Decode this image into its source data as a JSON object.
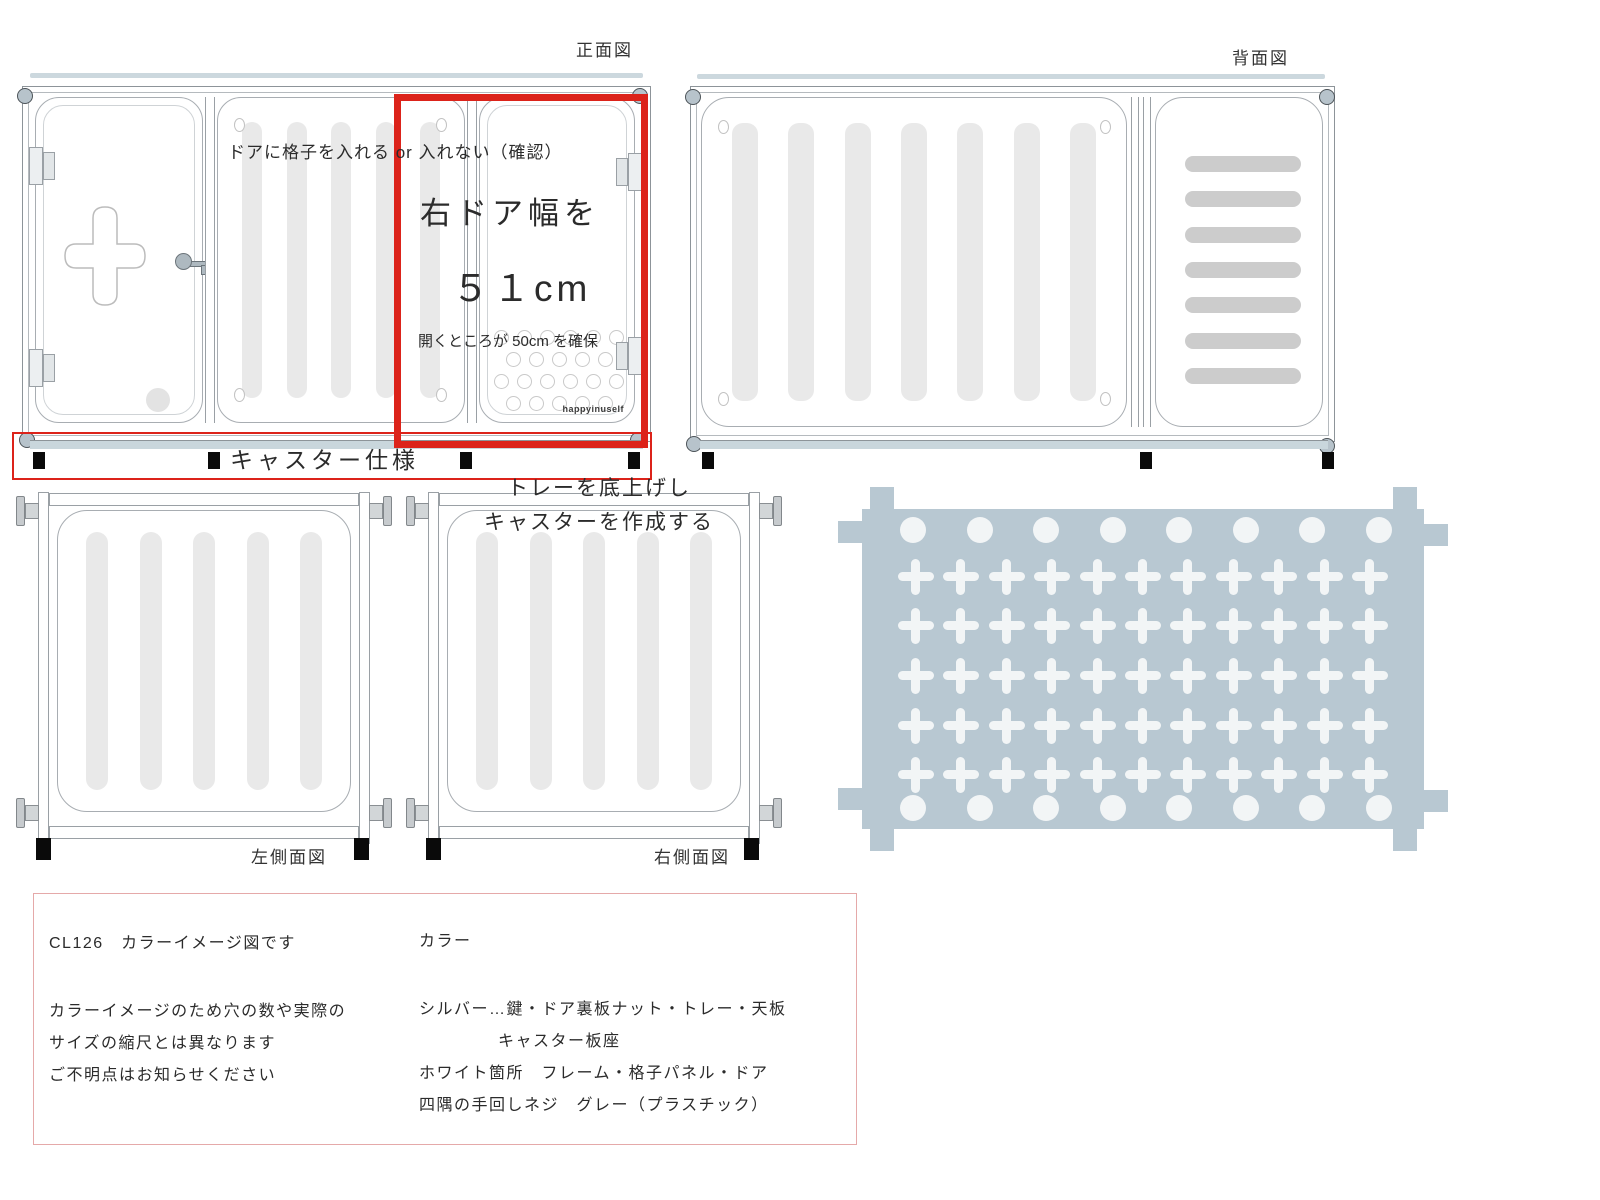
{
  "front": {
    "label": "正面図",
    "door_note": "ドアに格子を入れる or 入れない（確認）",
    "width_note_1": "右ドア幅を",
    "width_note_2": "５１cm",
    "width_note_3": "開くところが 50cm を確保",
    "brand": "happyinuself",
    "caster_note": "キャスター仕様",
    "mid_slots": {
      "count": 5,
      "cls": "slot",
      "name": "vent-slot"
    },
    "door_dots": {
      "r1": {
        "count": 6,
        "cls": "ring",
        "name": "vent-hole"
      },
      "r2": {
        "count": 5,
        "cls": "ring",
        "name": "vent-hole"
      },
      "r3": {
        "count": 6,
        "cls": "ring",
        "name": "vent-hole"
      },
      "r4": {
        "count": 5,
        "cls": "ring",
        "name": "vent-hole"
      }
    }
  },
  "back": {
    "label": "背面図",
    "main_slots": {
      "count": 7,
      "cls": "slot",
      "name": "vent-slot"
    },
    "side_bars": {
      "count": 7,
      "cls": "hbar",
      "name": "vent-slat"
    }
  },
  "left_side": {
    "label": "左側面図",
    "slots": {
      "count": 5,
      "cls": "slot",
      "name": "vent-slot"
    }
  },
  "right_side": {
    "label": "右側面図",
    "note_1": "トレーを底上げし",
    "note_2": "キャスターを作成する",
    "slots": {
      "count": 5,
      "cls": "slot",
      "name": "vent-slot"
    }
  },
  "tray": {
    "crosses": {
      "count": 55,
      "cls": "cross",
      "name": "cross-cutout-hole"
    },
    "dots_top": {
      "count": 8,
      "cls": "tray-dot",
      "name": "round-hole"
    },
    "dots_bottom": {
      "count": 8,
      "cls": "tray-dot",
      "name": "round-hole"
    }
  },
  "info_box": {
    "model_line": "CL126　カラーイメージ図です",
    "color_header": "カラー",
    "warning_1": "カラーイメージのため穴の数や実際の",
    "warning_2": "サイズの縮尺とは異なります",
    "contact": "ご不明点はお知らせください",
    "color_silver": "シルバー…鍵・ドア裏板ナット・トレー・天板",
    "color_silver_2": "キャスター板座",
    "color_white": "ホワイト箇所　フレーム・格子パネル・ドア",
    "color_gray": "四隅の手回しネジ　グレー（プラスチック）"
  },
  "colors": {
    "annotation_red": "#dc231a",
    "tray_blue_gray": "#b8c8d2",
    "bar_blue_gray": "#ccd8de",
    "slot_gray": "#e9e9e9",
    "slat_gray": "#cccccc",
    "info_border_pink": "#e5a9a9"
  }
}
